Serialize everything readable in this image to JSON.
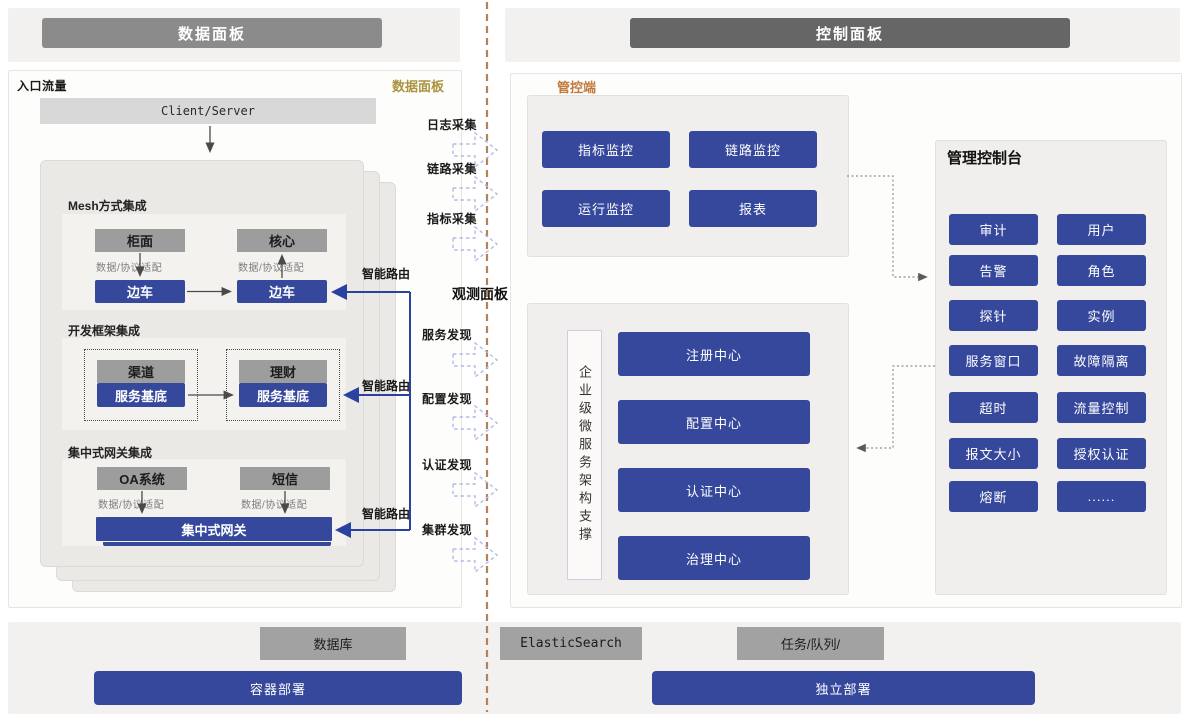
{
  "header": {
    "data_panel": "数据面板",
    "control_panel": "控制面板"
  },
  "data_panel": {
    "corner_label": "入口流量",
    "watermark": "数据面板",
    "entry": "Client/Server",
    "sections": [
      {
        "title": "Mesh方式集成",
        "boxes": {
          "left_top": "柜面",
          "right_top": "核心",
          "left_bottom": "边车",
          "right_bottom": "边车"
        },
        "adapter": "数据/协议适配"
      },
      {
        "title": "开发框架集成",
        "boxes": {
          "left_top": "渠道",
          "right_top": "理财",
          "left_bottom": "服务基底",
          "right_bottom": "服务基底"
        }
      },
      {
        "title": "集中式网关集成",
        "boxes": {
          "left_top": "OA系统",
          "right_top": "短信"
        },
        "adapter": "数据/协议适配",
        "gateway": "集中式网关"
      }
    ],
    "smart_route": "智能路由"
  },
  "flows": {
    "collect": [
      "日志采集",
      "链路采集",
      "指标采集"
    ],
    "observe_title": "观测面板",
    "discover": [
      "服务发现",
      "配置发现",
      "认证发现",
      "集群发现"
    ]
  },
  "mgmt": {
    "label": "管控端",
    "monitors": [
      "指标监控",
      "链路监控",
      "运行监控",
      "报表"
    ]
  },
  "observe": {
    "support_label": "企业级微服务架构支撑",
    "centers": [
      "注册中心",
      "配置中心",
      "认证中心",
      "治理中心"
    ]
  },
  "console": {
    "title": "管理控制台",
    "items": [
      "审计",
      "用户",
      "告警",
      "角色",
      "探针",
      "实例",
      "服务窗口",
      "故障隔离",
      "超时",
      "流量控制",
      "报文大小",
      "授权认证",
      "熔断",
      "......"
    ]
  },
  "infra": {
    "stores": [
      "数据库",
      "ElasticSearch",
      "任务/队列/"
    ],
    "deploys": [
      "容器部署",
      "独立部署"
    ]
  },
  "colors": {
    "module_blue": "#36489c",
    "gray_box": "#9d9d9d",
    "gold_label": "#ab9440",
    "orange_label": "#bf7b3d",
    "divider_brown": "#b5815c",
    "dashed_arrow_blue": "#b3bbe6",
    "route_line_blue": "#2a41a0"
  }
}
